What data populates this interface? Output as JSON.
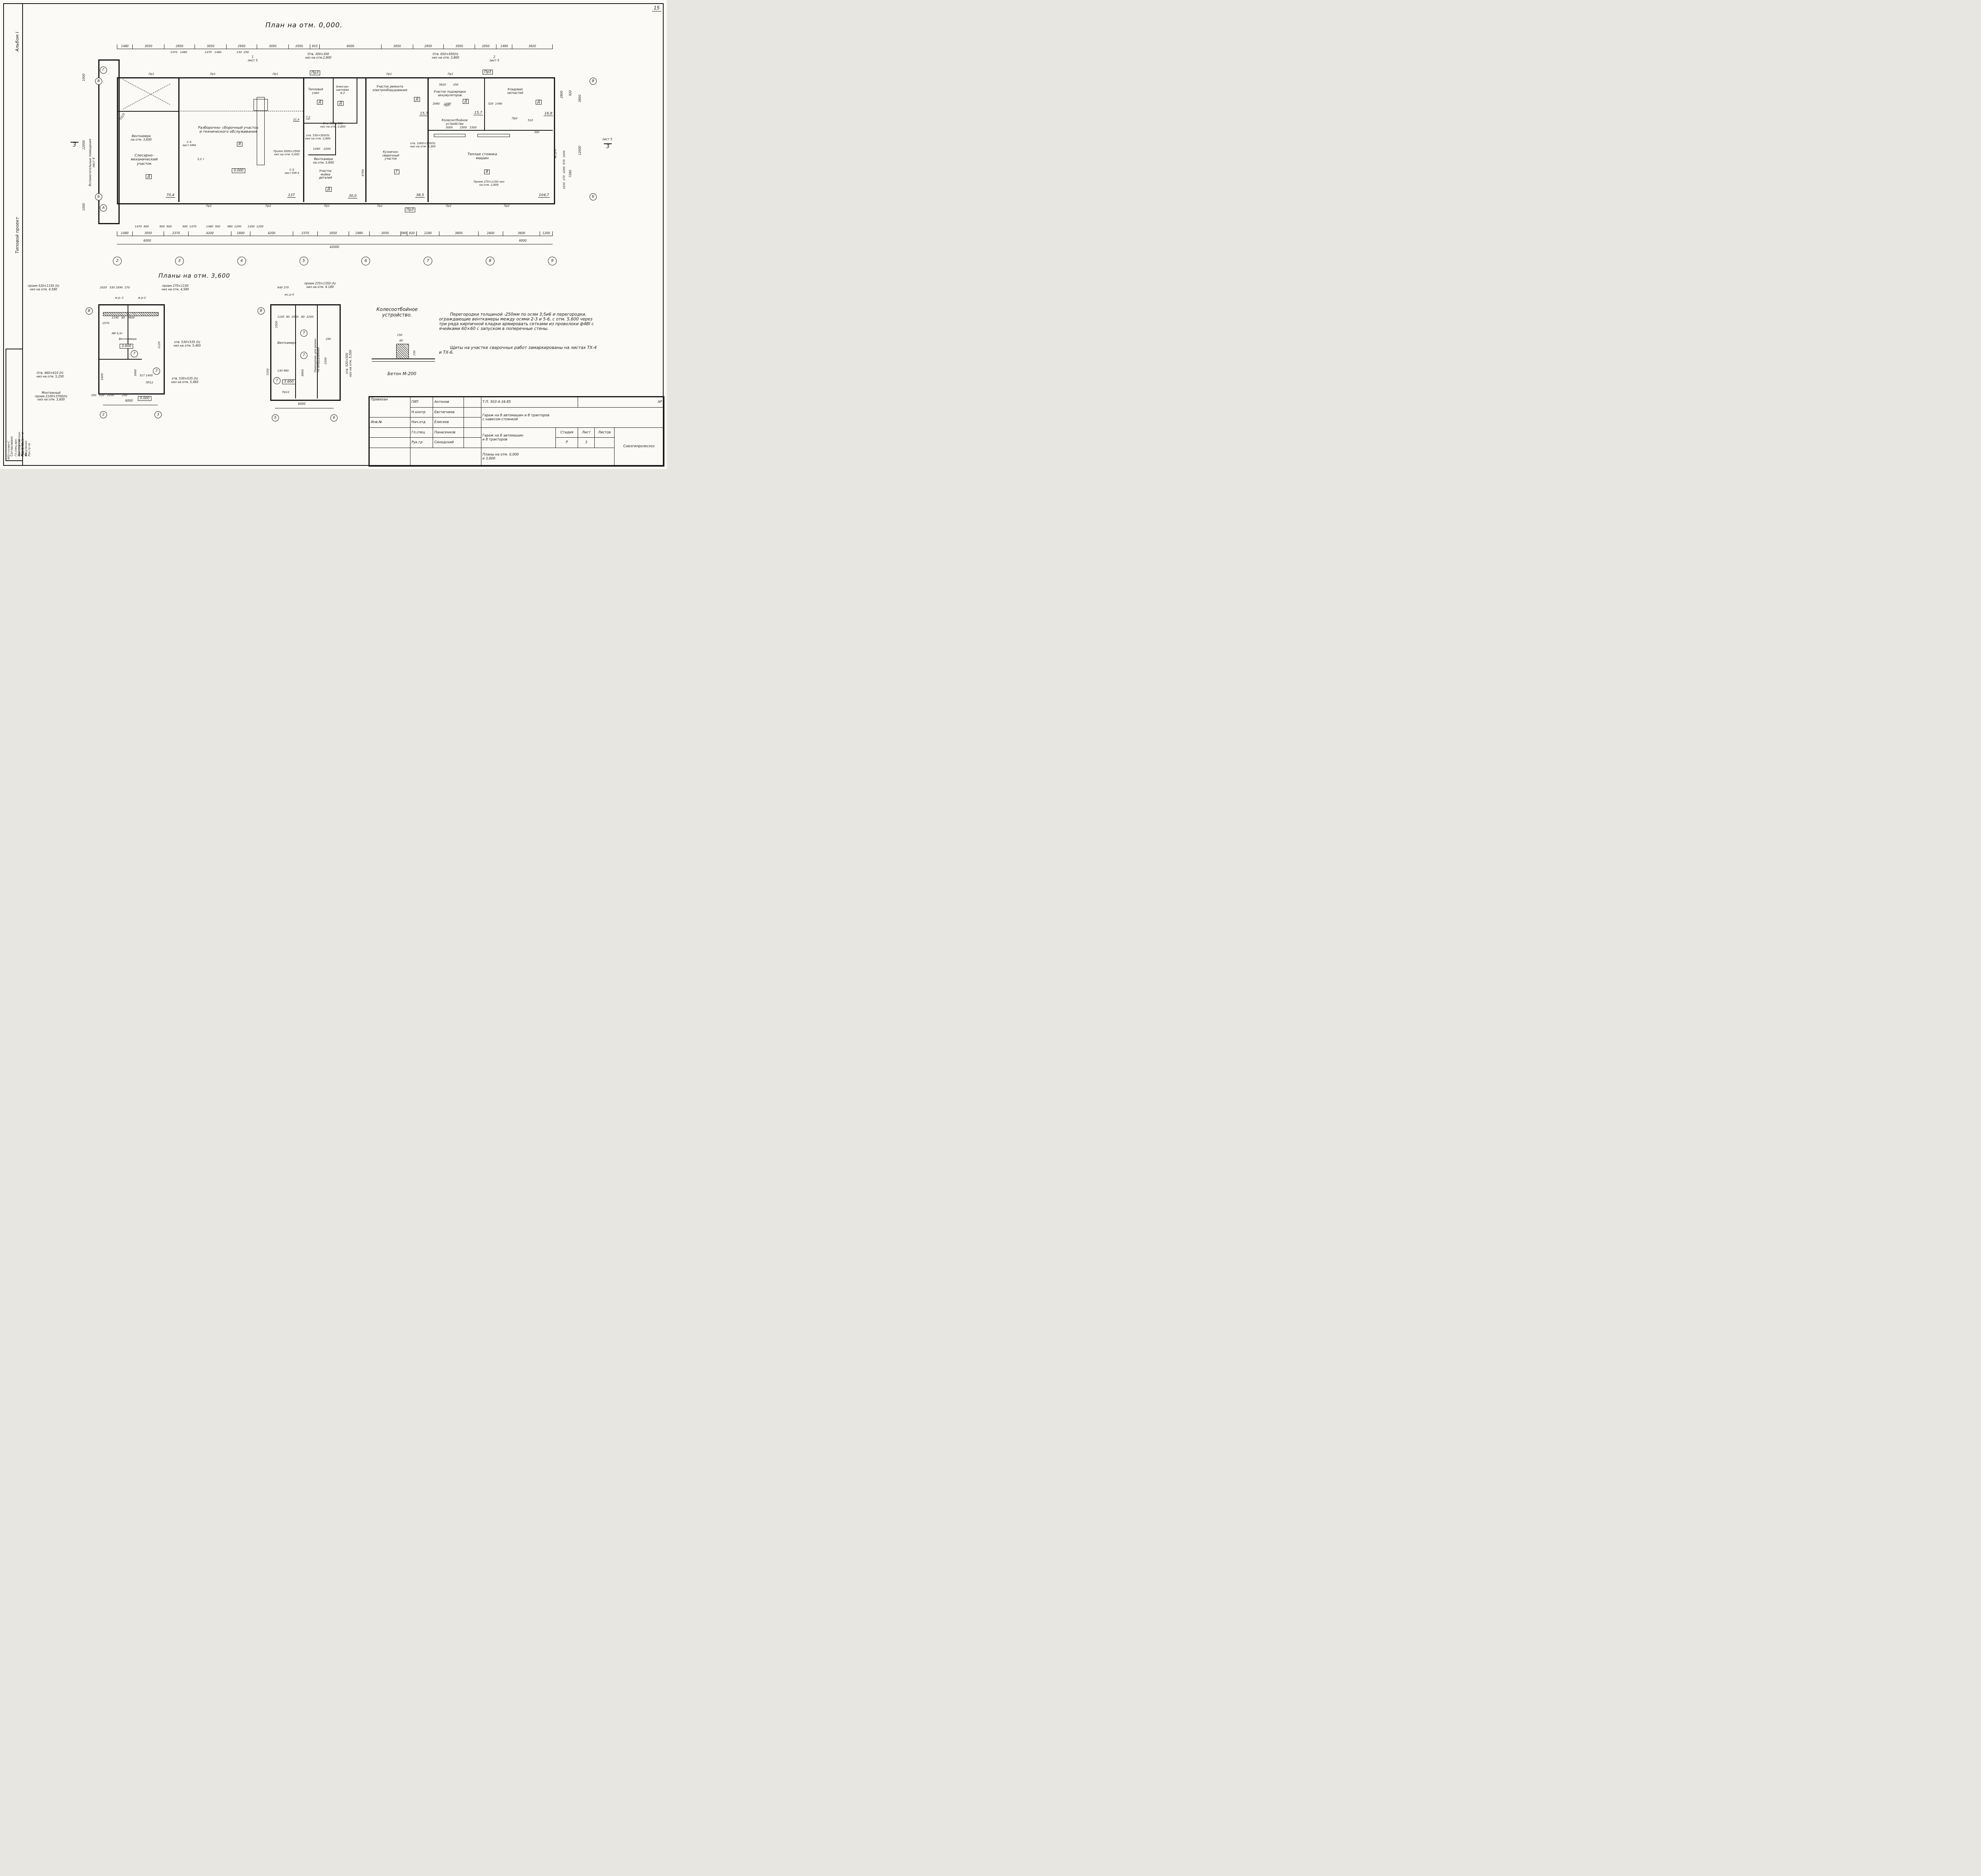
{
  "sheet": {
    "number": "15",
    "main_title": "План на отм. 0,000.",
    "plans36_title": "Планы на отм. 3,600"
  },
  "margin": {
    "album": "Альбом I",
    "project": "Типовой проект",
    "aux": "Вспомогательные помещения\nлист 4",
    "agree": "Согласовано",
    "agree_rows": [
      "Гл.спец.арх.   Екатеринов    Рук.гр эл",
      "Нач.отд.сантехн.  Маричева   Рук.гр вк",
      "Рук.гр.техн.   Вакуленко     Рук.гр св"
    ],
    "code": "602-гссово-С"
  },
  "axes": {
    "bottom": [
      "2",
      "3",
      "4",
      "5",
      "6",
      "7",
      "8",
      "9"
    ],
    "left_top1": "Г",
    "left_top2": "В",
    "left_bot1": "Б",
    "left_bot2": "А",
    "right_top": "В",
    "right_bot": "Б",
    "sect_left": "3",
    "sect_right_txt": "лист 5",
    "sect_right": "3"
  },
  "dims": {
    "top_row": [
      "1480",
      "3050",
      "2950",
      "3050",
      "2950",
      "3050",
      "2050",
      "910",
      "6000",
      "3050",
      "2950",
      "3050",
      "2050",
      "1490",
      "3920"
    ],
    "top_sub": "1470   1480                    1470   1480                 130  250",
    "bottom_sub": [
      "1480",
      "3050",
      "2370",
      "4200",
      "1800",
      "4200",
      "2370",
      "3050",
      "1980",
      "3050",
      "580",
      "920",
      "2180",
      "3800",
      "2400",
      "3600",
      "1200"
    ],
    "bottom_pairs": "1470  900            900  900            900  1470           1480  500        980  1200       1200  1200",
    "total_left": "6000",
    "total": "42000",
    "total_right": "6000",
    "left_top": "1000",
    "left_mid": "12000",
    "left_bot": "1000",
    "left_inner": "5525",
    "right_1": "2800",
    "right_2": "3800",
    "right_3": "920",
    "right_mid": "12000",
    "right_4": "7280",
    "right_inner": "1630  270  2200  970  1630",
    "right_510": "510",
    "right_390": "390",
    "stoyanka_dims": "3000        2500   1500"
  },
  "rooms": {
    "slesar": {
      "label": "Слесарно-\nмеханический\nучасток",
      "letter": "Д",
      "area": "70,4"
    },
    "vent1": {
      "label": "Венткамера\nна отм. 3,600"
    },
    "razbor": {
      "label": "Разборочно- сборочный участок\nи технического  обслуживания",
      "letter": "В",
      "area": "137",
      "elev": "0.000"
    },
    "teplo": {
      "label": "Тепловой\nузел",
      "letter": "Д",
      "area": "7,2"
    },
    "electro": {
      "label": "Электро-\nщитовая\n8,3",
      "letter": "Д",
      "area": "21,4"
    },
    "remont": {
      "label": "Участок ремонта\nэлектрооборудования",
      "letter": "Д",
      "area": "15,7"
    },
    "podzar": {
      "label": "Участок подзарядки\nаккумуляторов",
      "letter": "Д",
      "area": "15,7",
      "dims": "5620        250",
      "dims2": "2080     1490"
    },
    "klad": {
      "label": "Кладовая\nзапчастей",
      "letter": "Д",
      "area": "16,8",
      "dims": "520  1490"
    },
    "vent2": {
      "label": "Венткамера\nна отм. 3,600",
      "dims": "1490    2200"
    },
    "moyka": {
      "label": "Участок\nмойки\nдеталей",
      "letter": "Д",
      "area": "30,0"
    },
    "kuzn": {
      "label": "Кузнечно-\nсварочный\nучасток",
      "letter": "Г",
      "area": "38,5",
      "dim": "6700"
    },
    "stoyanka": {
      "label": "Теплая  стоянка\nмашин",
      "letter": "В",
      "area": "104,7"
    },
    "koleso": {
      "label": "Колесоотбойное\nустройство"
    }
  },
  "annotations": {
    "a1": "Отв. 500×500\nниз на отм. 2,800",
    "a2": "отв. 530×500(h)\nниз на отм. 2,800",
    "a3": "Отв. 300×300\nниз на отм.2,800",
    "a4": "Отв. 650×450(h)\nниз на отм. 3,800",
    "a5": "отв. 1000×500(h)\nниз на отм. 3,300",
    "a6": "Проем 3000×2500\nниз на отм. 0,000",
    "a7": "Проем 270×1150 низ\nна отм. 2,600",
    "c5a": "С-5\nлист КМ4",
    "c5b": "С-5\nлист КМ-4",
    "crane": "3,2 т",
    "sect1": "1\nлист 5",
    "sect2": "2\nлист 5",
    "elev0": "0.000",
    "pr1": "Пр1",
    "pr2": "Пр2",
    "pr3": "Пр3",
    "pr5": "Пр5",
    "prn": "ПрН",
    "prii": "ПрII",
    "zhr2": "жс.р-2"
  },
  "plan1": {
    "ann_top_left": "проем 530×1150 (h)\nниз на отм. 4,580",
    "dims_top": "2020   530 1690  270",
    "ann_top_right": "проем 270×1150\nниз на отм. 4,580",
    "m1": "ж.р.-1",
    "m2": "ж.р-2",
    "mr": "МР 0,5т",
    "room": "Венткамера",
    "elev": "3.600",
    "elev0": "0.000",
    "ann_r1": "отв. 530×535 (h)\nниз на отм. 5,465",
    "ann_r2": "отв. 530×535 (h)\nниз на отм. 5,465",
    "ann_l1": "Отв. 660×610 (h)\nниз на отм. 5,250",
    "ann_l2": "Монтажный\nпроем 2100×3700(h)\nниз на отм. 3,600",
    "d1": "1570",
    "d2": "1190   80   2600",
    "d3": "5400",
    "d4": "3060",
    "d5": "2120",
    "d6": "250   520   2100         250",
    "d7": "317  1400",
    "total": "6000",
    "ax_left": "В",
    "ax1": "2",
    "ax2": "3",
    "ax7": "7",
    "pr12": "ПР12"
  },
  "plan2": {
    "ann_top": "проем 270×1350 (h)\nниз на отм. 4.180",
    "dims_top": "640 270",
    "m1": "жс.р-3",
    "room": "Венткамера",
    "room2": "Помещение для ремон-\nта оборудования",
    "ann_r": "отв. 520×500\nниз на отм. 5,500",
    "elev": "3.600",
    "d1": "2500",
    "d2": "1100  80  2540   80  2200",
    "d3": "7250",
    "d4": "6900",
    "d5": "2590",
    "d6": "130 960",
    "d7": "250",
    "total": "6000",
    "ax_left": "В",
    "ax1": "5",
    "ax2": "6",
    "ax7": "7",
    "pr12": "Пр12"
  },
  "detail": {
    "title": "Колесоотбойное\nустройство.",
    "d1": "150",
    "d2": "80",
    "d3": "150",
    "caption": "Бетон М-200"
  },
  "notes": {
    "p1": "Перегородки толщиной -250мм по осям 3;5и6 и перегородки, ограждающие венткамеры между осями 2-3 и 5-6, с отм. 5,600 через три ряда кирпичной кладки армировать сетками из проволоки ф4ВI с ячейками 60×60 с запуском в поперечные стены.",
    "p2": "Щиты на участке сварочных работ замаркированы на листах ТХ-4 и ТХ-6."
  },
  "titleblock": {
    "attach": "Привязан",
    "roles": [
      {
        "role": "ГИП",
        "name": "Антонов"
      },
      {
        "role": "Н.контр",
        "name": "Евстигнеев"
      },
      {
        "role": "Нач.отд",
        "name": "Елисеев"
      },
      {
        "role": "Гл.спец",
        "name": "Панасенков"
      },
      {
        "role": "Рук.гр",
        "name": "Синодский"
      }
    ],
    "doc": "Т.П. 503-4-34.85",
    "mark": "АР",
    "title1": "Гараж на 8 автомашин и 8 тракторов\nс навесом-стоянкой",
    "title2": "Гараж  на 8 автомашин\nи 8 тракторов",
    "stage_label": "Стадия",
    "sheet_label": "Лист",
    "sheets_label": "Листов",
    "stage": "Р",
    "sheet": "3",
    "subtitle": "Планы на отм. 0,000\nи 3,600",
    "org": "Союзгипролесхоз",
    "inv": "Инв.№"
  }
}
